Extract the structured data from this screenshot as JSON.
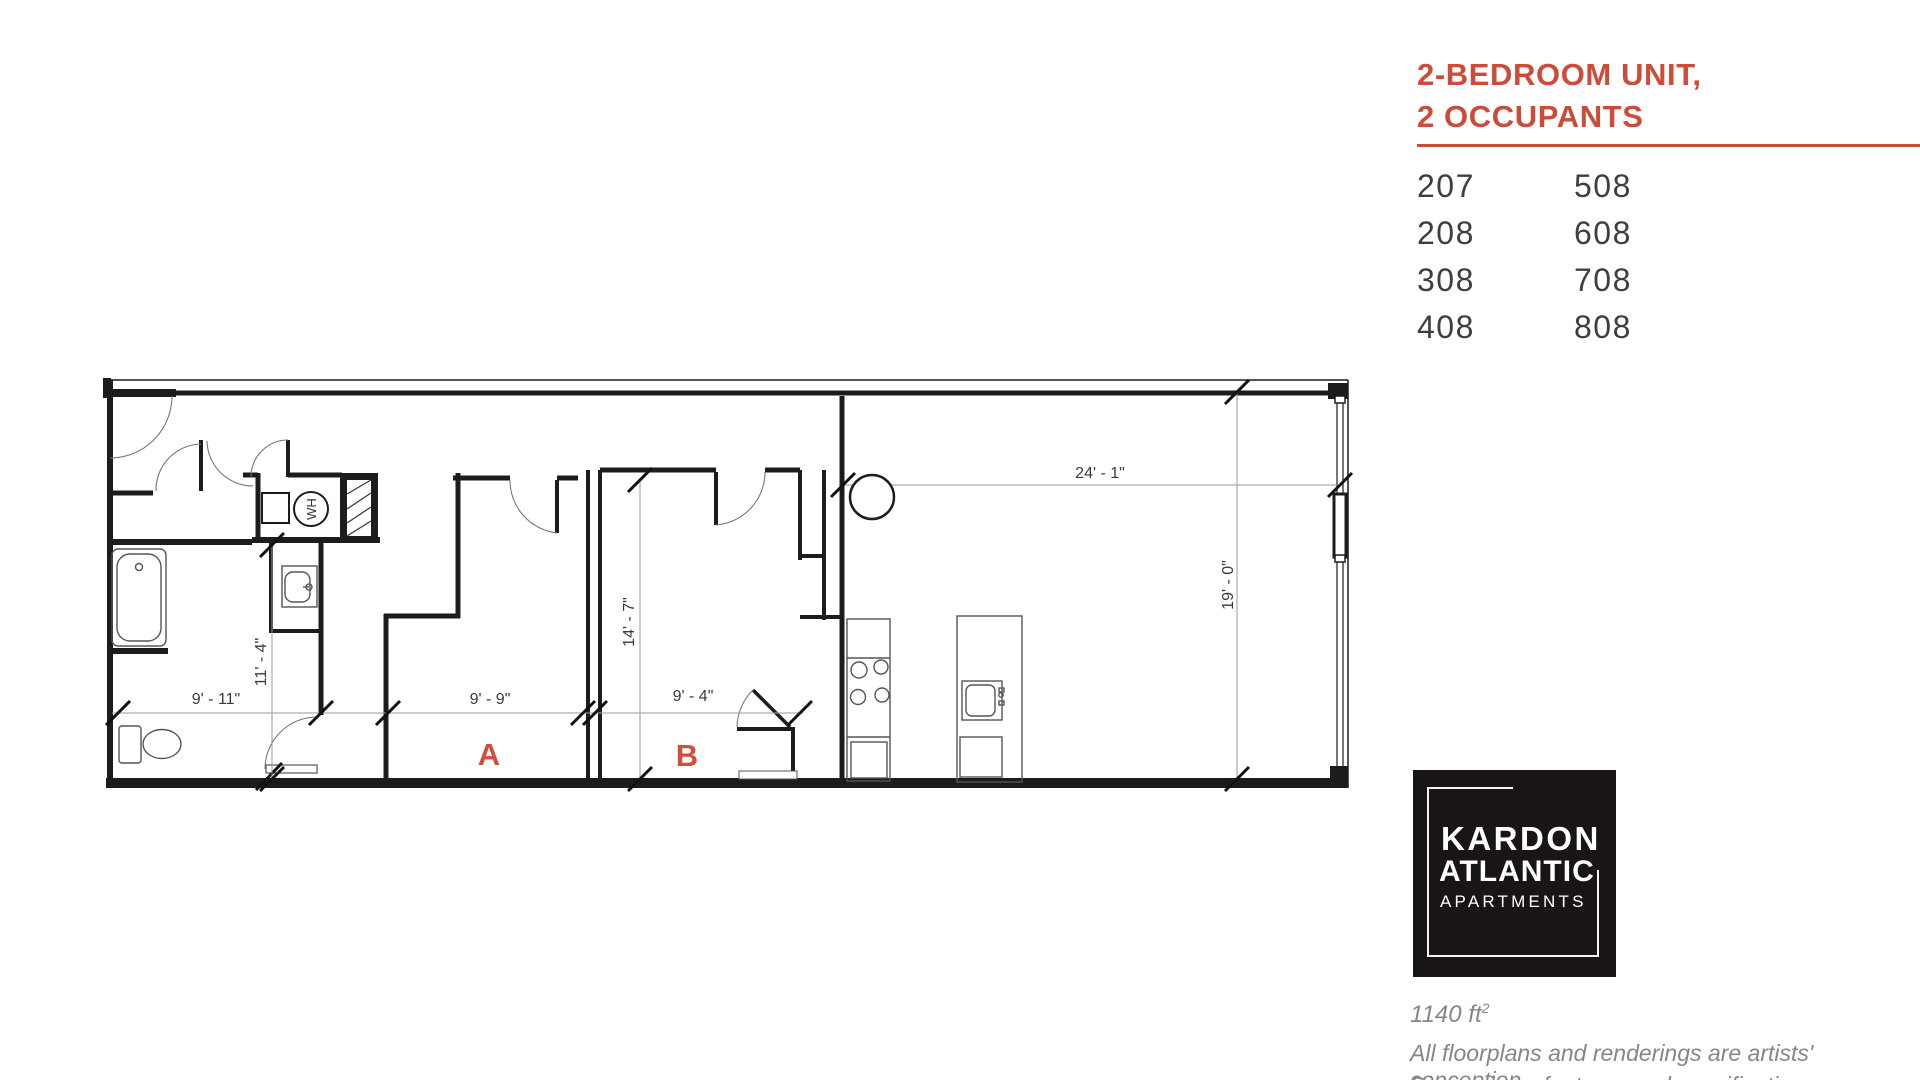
{
  "header": {
    "title_line1": "2-BEDROOM UNIT,",
    "title_line2": "2 OCCUPANTS"
  },
  "units": {
    "rows": [
      {
        "left": "207",
        "right": "508"
      },
      {
        "left": "208",
        "right": "608"
      },
      {
        "left": "308",
        "right": "708"
      },
      {
        "left": "408",
        "right": "808"
      }
    ]
  },
  "logo": {
    "name_line1": "KARDON",
    "name_line2": "ATLANTIC",
    "name_line3": "APARTMENTS"
  },
  "footer": {
    "area_value": "1140 ft",
    "area_exponent": "2",
    "disclaimer_line1": "All floorplans and renderings are artists' conception.",
    "disclaimer_line2": "Dimensions, features and specifications are subject to"
  },
  "floorplan": {
    "room_labels": {
      "bedroom_a": "A",
      "bedroom_b": "B"
    },
    "fixture_labels": {
      "water_heater": "WH"
    },
    "dimensions": {
      "living_width": "24' - 1\"",
      "living_depth": "19' - 0\"",
      "bath_width": "9' - 11\"",
      "bath_depth": "11' - 4\"",
      "bedroom_a_width": "9' - 9\"",
      "bedroom_depth": "14' - 7\"",
      "bedroom_b_width": "9' - 4\""
    }
  },
  "colors": {
    "accent": "#cd4c39",
    "wall": "#1c1c1c",
    "dim_line": "#9a9a9a",
    "dim_text": "#3a3a3a",
    "gray_text": "#868686",
    "units_text": "#3e3e3e",
    "logo_bg": "#191514"
  }
}
